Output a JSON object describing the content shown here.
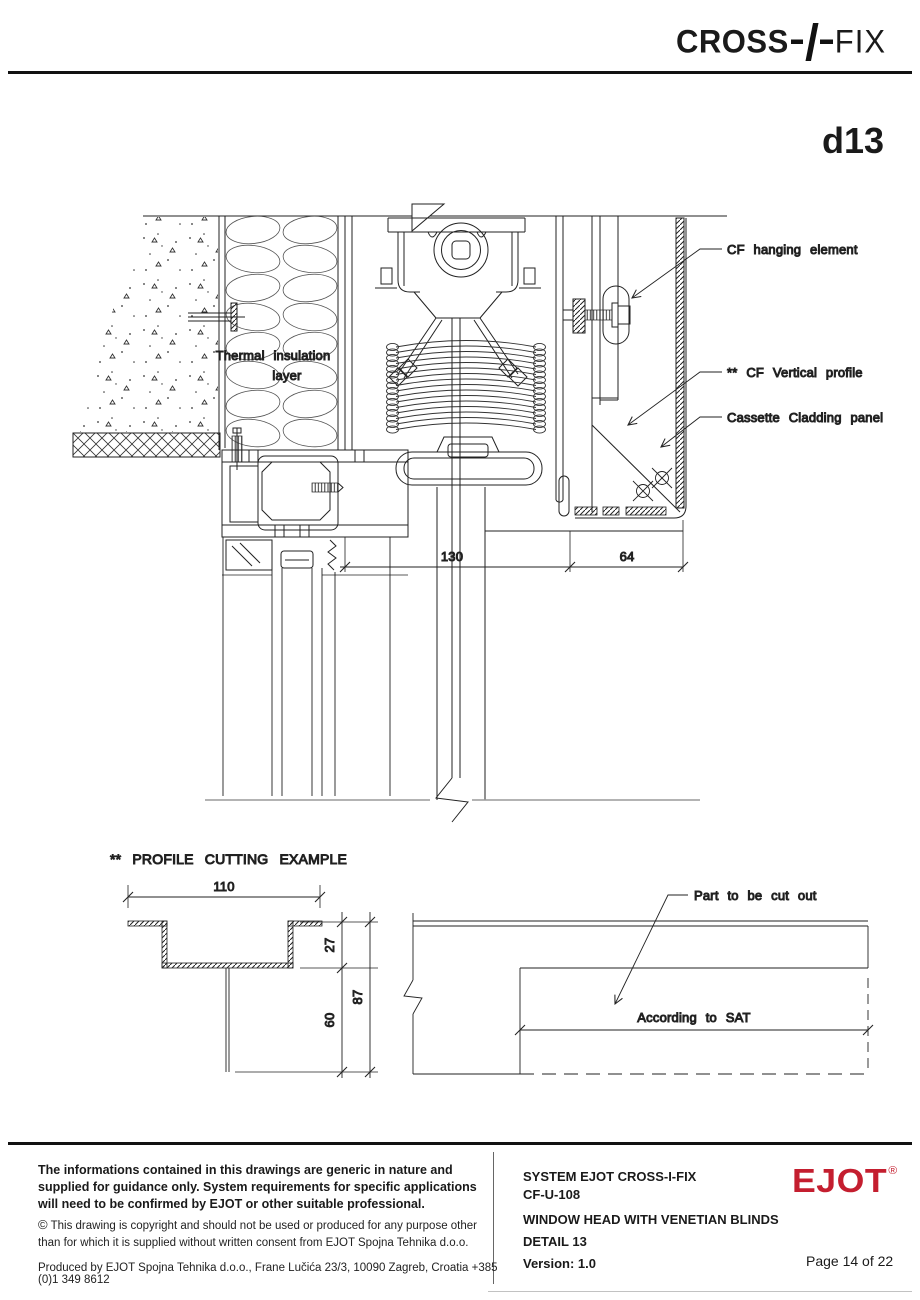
{
  "colors": {
    "ejot_red": "#c41e2f",
    "line": "#222222"
  },
  "header": {
    "brand_left": "CROSS",
    "brand_right": "FIX",
    "detail_code": "d13"
  },
  "main_drawing": {
    "labels": {
      "hanging_element": "CF hanging element",
      "vertical_profile": "** CF Vertical profile",
      "cladding_panel": "Cassette Cladding panel",
      "insulation_line1": "Thermal insulation",
      "insulation_line2": "layer"
    },
    "dimensions": {
      "width_130": "130",
      "width_64": "64"
    }
  },
  "cutting_example": {
    "title": "** PROFILE CUTTING EXAMPLE",
    "dims": {
      "width": "110",
      "top": "27",
      "bottom": "60",
      "total": "87"
    },
    "labels": {
      "cut_part": "Part to be cut out",
      "according": "According to SAT"
    }
  },
  "footer": {
    "disclaimer_bold": "The informations contained in this drawings are generic in nature and supplied for guidance only. System requirements for specific applications will need to be confirmed by EJOT or other suitable professional.",
    "copyright_icon": "©",
    "copyright": "This drawing is copyright and should not be used or produced for any purpose other than for which it is supplied without written consent from EJOT Spojna Tehnika d.o.o.",
    "produced": "Produced by EJOT Spojna Tehnika d.o.o., Frane Lučića 23/3, 10090 Zagreb, Croatia +385 (0)1 349 8612",
    "system": "SYSTEM EJOT CROSS-I-FIX",
    "code": "CF-U-108",
    "title": "WINDOW HEAD WITH VENETIAN BLINDS",
    "detail": "DETAIL 13",
    "version": "Version: 1.0",
    "brand": "EJOT",
    "reg": "®",
    "page": "Page 14 of 22"
  }
}
